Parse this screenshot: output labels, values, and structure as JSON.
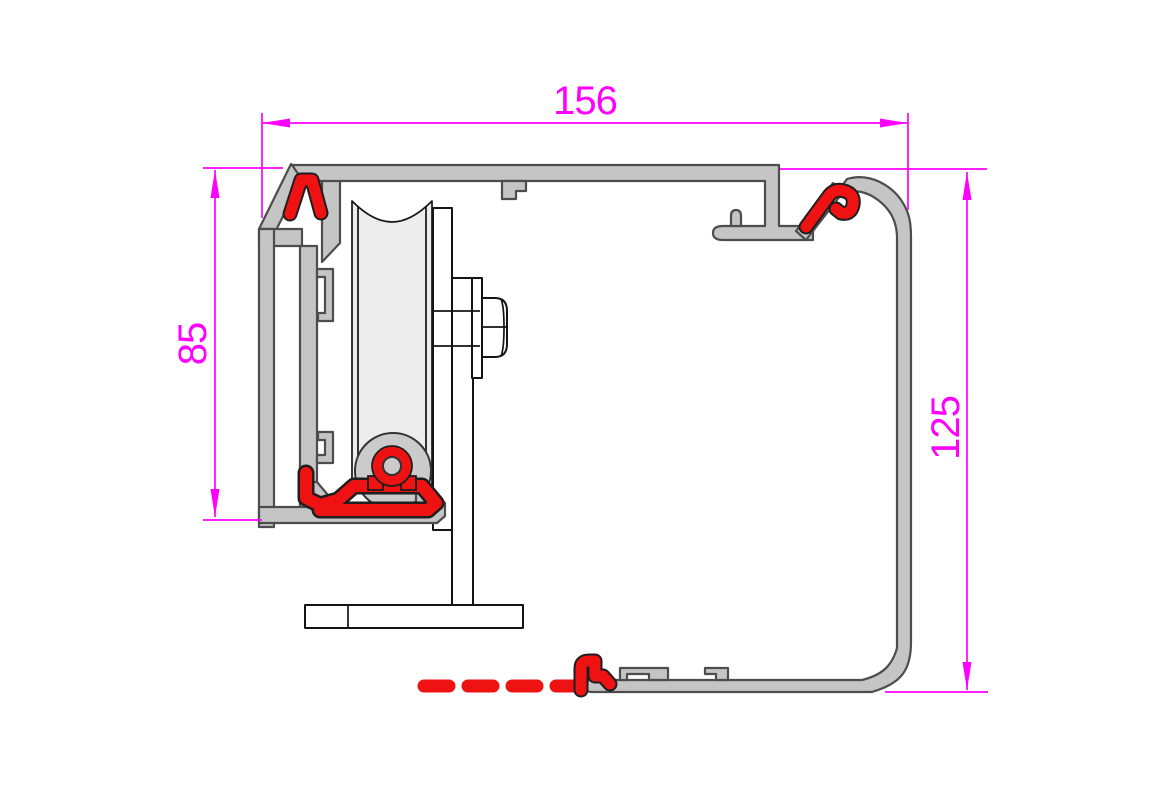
{
  "drawing": {
    "dimension_labels": {
      "top_width": "156",
      "left_height": "85",
      "right_height": "125"
    },
    "colors": {
      "dimension": "#FF00FF",
      "aluminum": "#C5C5C5",
      "aluminum_light": "#CBCBCB",
      "aluminum_outline": "#4D4D4D",
      "gasket_red": "#EE1312",
      "gasket_outline": "#1E1E1E",
      "roller_fill": "#EDEDED",
      "hardware_fill": "#FFFFFF",
      "hardware_outline": "#141414",
      "background": "#FFFFFF"
    },
    "parts": [
      "top-track-rail",
      "left-glazing-flange",
      "upper-left-gasket",
      "left-channel-wall",
      "inner-support-wall",
      "bottom-left-gasket",
      "roller-wheel",
      "wheel-hub",
      "hub-gasket-ring",
      "roller-bracket",
      "axle-bolt",
      "bracket-foot",
      "right-hanger-arm",
      "upper-right-gasket",
      "right-cover-wall",
      "bottom-rail",
      "floor-seal-dashed"
    ]
  }
}
